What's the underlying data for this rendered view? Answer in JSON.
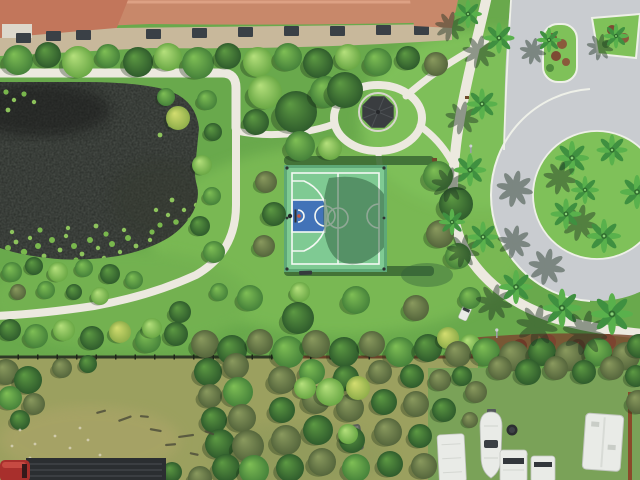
{
  "meta": {
    "kind": "aerial-photograph",
    "subject": "community-basketball-court-and-pond"
  },
  "palette": {
    "grass": "#69a94c",
    "grassLight": "#7fc159",
    "grassDim": "#58923f",
    "water": "#272b27",
    "lily": "#7fc24f",
    "path": "#ece9df",
    "road": "#c9ccd0",
    "curb": "#eef0e8",
    "roofMain": "#c8886a",
    "roofLeft": "#c2765b",
    "facade": "#c8b89b",
    "windowDark": "#3a4046",
    "courtGreen": "#7fca93",
    "courtLine": "#f4f8f3",
    "keyBlue": "#4273b8",
    "gazebo": "#3a3d40",
    "mulch": "#7b4a30",
    "rust": "#8a4a2a",
    "fenceDark": "#2f3a26",
    "fieldTan": "#9ba05f",
    "yardGreen": "#7aa258",
    "vehicleWhite": "#e9ebe7",
    "truckRed": "#a82f2c",
    "trailerDark": "#2b2e31"
  },
  "scene": {
    "regions": [
      "townhomes-with-tile-roofs",
      "pond-with-lily-pads",
      "basketball-court",
      "gazebo",
      "walkway-network",
      "circular-road-with-palm-island",
      "median-islands",
      "perimeter-fence",
      "rough-field",
      "boat-and-rv-yard"
    ],
    "windows": [
      [
        16,
        33
      ],
      [
        46,
        31
      ],
      [
        76,
        30
      ],
      [
        146,
        29
      ],
      [
        192,
        28
      ],
      [
        238,
        27
      ],
      [
        284,
        26
      ],
      [
        330,
        26
      ],
      [
        376,
        25
      ],
      [
        414,
        25
      ]
    ],
    "trees": [
      [
        18,
        60,
        15,
        "md"
      ],
      [
        48,
        55,
        13,
        "dk"
      ],
      [
        78,
        62,
        16,
        "lt"
      ],
      [
        108,
        56,
        12,
        "md"
      ],
      [
        138,
        62,
        15,
        "dk"
      ],
      [
        168,
        57,
        14,
        "lt"
      ],
      [
        198,
        63,
        16,
        "md"
      ],
      [
        228,
        56,
        13,
        "dk"
      ],
      [
        258,
        62,
        15,
        "lt"
      ],
      [
        288,
        57,
        14,
        "md"
      ],
      [
        318,
        63,
        15,
        "dk"
      ],
      [
        348,
        57,
        13,
        "lt"
      ],
      [
        378,
        62,
        14,
        "md"
      ],
      [
        408,
        58,
        12,
        "dk"
      ],
      [
        436,
        64,
        12,
        "ol"
      ],
      [
        265,
        92,
        17,
        "lt"
      ],
      [
        296,
        112,
        21,
        "dk"
      ],
      [
        326,
        92,
        16,
        "md"
      ],
      [
        256,
        122,
        13,
        "dk"
      ],
      [
        300,
        146,
        15,
        "md"
      ],
      [
        330,
        148,
        12,
        "lt"
      ],
      [
        345,
        90,
        18,
        "dk"
      ],
      [
        207,
        100,
        10,
        "md"
      ],
      [
        213,
        132,
        9,
        "dk"
      ],
      [
        202,
        165,
        10,
        "lt"
      ],
      [
        212,
        196,
        9,
        "md"
      ],
      [
        200,
        226,
        10,
        "dk"
      ],
      [
        214,
        252,
        11,
        "md"
      ],
      [
        178,
        118,
        12,
        "yl"
      ],
      [
        166,
        97,
        9,
        "md"
      ],
      [
        266,
        182,
        11,
        "ol"
      ],
      [
        274,
        214,
        12,
        "dk"
      ],
      [
        264,
        246,
        11,
        "ol"
      ],
      [
        438,
        176,
        15,
        "md"
      ],
      [
        456,
        204,
        17,
        "dk"
      ],
      [
        440,
        234,
        14,
        "ol"
      ],
      [
        458,
        256,
        13,
        "md"
      ],
      [
        250,
        298,
        13,
        "md"
      ],
      [
        298,
        318,
        16,
        "dk"
      ],
      [
        356,
        300,
        14,
        "md"
      ],
      [
        300,
        292,
        10,
        "lt"
      ],
      [
        416,
        308,
        13,
        "ol"
      ],
      [
        470,
        298,
        11,
        "md"
      ],
      [
        180,
        312,
        11,
        "dk"
      ],
      [
        219,
        292,
        9,
        "md"
      ],
      [
        12,
        272,
        10,
        "md"
      ],
      [
        34,
        266,
        9,
        "dk"
      ],
      [
        58,
        272,
        10,
        "lt"
      ],
      [
        84,
        268,
        9,
        "md"
      ],
      [
        110,
        274,
        10,
        "dk"
      ],
      [
        134,
        280,
        9,
        "md"
      ],
      [
        18,
        292,
        8,
        "ol"
      ],
      [
        46,
        290,
        9,
        "md"
      ],
      [
        74,
        292,
        8,
        "dk"
      ],
      [
        100,
        296,
        9,
        "lt"
      ],
      [
        10,
        330,
        11,
        "dk"
      ],
      [
        36,
        336,
        12,
        "md"
      ],
      [
        64,
        330,
        11,
        "lt"
      ],
      [
        92,
        338,
        12,
        "dk"
      ],
      [
        120,
        332,
        11,
        "yl"
      ],
      [
        148,
        340,
        13,
        "md"
      ],
      [
        176,
        334,
        12,
        "dk"
      ],
      [
        152,
        328,
        10,
        "lt"
      ],
      [
        205,
        344,
        14,
        "ol"
      ],
      [
        232,
        350,
        15,
        "dk"
      ],
      [
        260,
        342,
        13,
        "ol"
      ],
      [
        288,
        352,
        16,
        "md"
      ],
      [
        316,
        344,
        14,
        "ol"
      ],
      [
        344,
        352,
        15,
        "dk"
      ],
      [
        372,
        344,
        13,
        "ol"
      ],
      [
        400,
        352,
        15,
        "md"
      ],
      [
        428,
        348,
        14,
        "dk"
      ],
      [
        448,
        338,
        11,
        "yl"
      ],
      [
        470,
        344,
        10,
        "lt"
      ],
      [
        458,
        354,
        13,
        "ol"
      ],
      [
        486,
        352,
        14,
        "md"
      ],
      [
        514,
        356,
        15,
        "ol"
      ],
      [
        542,
        352,
        14,
        "dk"
      ],
      [
        570,
        356,
        15,
        "ol"
      ],
      [
        598,
        352,
        14,
        "md"
      ],
      [
        626,
        356,
        14,
        "ol"
      ],
      [
        639,
        346,
        12,
        "dk"
      ],
      [
        6,
        372,
        13,
        "ol"
      ],
      [
        28,
        380,
        14,
        "dk"
      ],
      [
        10,
        398,
        12,
        "md"
      ],
      [
        34,
        404,
        11,
        "ol"
      ],
      [
        20,
        420,
        10,
        "dk"
      ],
      [
        62,
        368,
        10,
        "ol"
      ],
      [
        88,
        364,
        9,
        "dk"
      ],
      [
        208,
        372,
        14,
        "dk"
      ],
      [
        236,
        366,
        13,
        "ol"
      ],
      [
        210,
        396,
        12,
        "ol"
      ],
      [
        238,
        392,
        15,
        "md"
      ],
      [
        214,
        420,
        13,
        "dk"
      ],
      [
        242,
        418,
        14,
        "ol"
      ],
      [
        220,
        444,
        15,
        "dk"
      ],
      [
        248,
        446,
        16,
        "ol"
      ],
      [
        226,
        468,
        14,
        "dk"
      ],
      [
        254,
        470,
        15,
        "md"
      ],
      [
        282,
        380,
        14,
        "ol"
      ],
      [
        282,
        410,
        13,
        "dk"
      ],
      [
        286,
        440,
        15,
        "ol"
      ],
      [
        290,
        468,
        14,
        "dk"
      ],
      [
        312,
        372,
        13,
        "md"
      ],
      [
        316,
        400,
        14,
        "ol"
      ],
      [
        318,
        430,
        15,
        "dk"
      ],
      [
        322,
        462,
        14,
        "ol"
      ],
      [
        346,
        378,
        13,
        "dk"
      ],
      [
        350,
        408,
        14,
        "ol"
      ],
      [
        352,
        440,
        13,
        "dk"
      ],
      [
        356,
        468,
        14,
        "md"
      ],
      [
        380,
        372,
        12,
        "ol"
      ],
      [
        384,
        402,
        13,
        "dk"
      ],
      [
        388,
        432,
        14,
        "ol"
      ],
      [
        390,
        464,
        13,
        "dk"
      ],
      [
        412,
        376,
        12,
        "dk"
      ],
      [
        416,
        404,
        13,
        "ol"
      ],
      [
        420,
        436,
        12,
        "dk"
      ],
      [
        424,
        466,
        13,
        "ol"
      ],
      [
        330,
        392,
        14,
        "lt"
      ],
      [
        358,
        388,
        12,
        "yl"
      ],
      [
        305,
        388,
        11,
        "lt"
      ],
      [
        440,
        380,
        11,
        "ol"
      ],
      [
        444,
        410,
        12,
        "dk"
      ],
      [
        348,
        434,
        10,
        "lt"
      ],
      [
        500,
        368,
        12,
        "ol"
      ],
      [
        528,
        372,
        13,
        "dk"
      ],
      [
        556,
        368,
        12,
        "ol"
      ],
      [
        584,
        372,
        12,
        "dk"
      ],
      [
        612,
        368,
        12,
        "ol"
      ],
      [
        636,
        376,
        11,
        "dk"
      ],
      [
        638,
        402,
        12,
        "ol"
      ],
      [
        476,
        392,
        11,
        "ol"
      ],
      [
        462,
        376,
        10,
        "dk"
      ],
      [
        470,
        420,
        8,
        "ol"
      ],
      [
        200,
        478,
        12,
        "ol"
      ],
      [
        172,
        472,
        10,
        "dk"
      ]
    ],
    "palms": [
      [
        572,
        158,
        1.1,
        2,
        1
      ],
      [
        612,
        150,
        1.0,
        2,
        1
      ],
      [
        637,
        192,
        1.1,
        2,
        1
      ],
      [
        566,
        214,
        1.0,
        2,
        1
      ],
      [
        604,
        236,
        1.1,
        2,
        1
      ],
      [
        585,
        190,
        0.9,
        0,
        1
      ],
      [
        499,
        38,
        1.0,
        1,
        0
      ],
      [
        482,
        104,
        1.0,
        1,
        1
      ],
      [
        470,
        170,
        1.05,
        1,
        1
      ],
      [
        483,
        237,
        1.0,
        1,
        1
      ],
      [
        516,
        287,
        1.1,
        1,
        1
      ],
      [
        562,
        308,
        1.25,
        1,
        0
      ],
      [
        612,
        314,
        1.35,
        1,
        0
      ],
      [
        549,
        40,
        0.8,
        1,
        0
      ],
      [
        616,
        36,
        0.8,
        1,
        0
      ],
      [
        468,
        14,
        0.9,
        1,
        0
      ],
      [
        452,
        222,
        0.85,
        0,
        0
      ]
    ],
    "lilies": [
      [
        8,
        248,
        3
      ],
      [
        16,
        242,
        2.4
      ],
      [
        24,
        252,
        3.2
      ],
      [
        30,
        238,
        2.2
      ],
      [
        38,
        246,
        3
      ],
      [
        44,
        256,
        2.4
      ],
      [
        52,
        240,
        3
      ],
      [
        60,
        250,
        2.4
      ],
      [
        66,
        236,
        2.2
      ],
      [
        74,
        246,
        3
      ],
      [
        82,
        254,
        2.4
      ],
      [
        90,
        240,
        3
      ],
      [
        98,
        248,
        2.2
      ],
      [
        106,
        234,
        2.6
      ],
      [
        112,
        244,
        3
      ],
      [
        120,
        252,
        2.2
      ],
      [
        128,
        238,
        3
      ],
      [
        136,
        246,
        2.4
      ],
      [
        144,
        254,
        3
      ],
      [
        150,
        240,
        2.2
      ],
      [
        158,
        248,
        2.6
      ],
      [
        20,
        260,
        2.4
      ],
      [
        48,
        262,
        2.2
      ],
      [
        76,
        260,
        2.6
      ],
      [
        104,
        258,
        2.2
      ],
      [
        132,
        258,
        2.6
      ],
      [
        12,
        232,
        2.2
      ],
      [
        40,
        230,
        2.6
      ],
      [
        68,
        228,
        2.2
      ],
      [
        96,
        226,
        2.4
      ],
      [
        124,
        230,
        2.2
      ],
      [
        152,
        232,
        2.6
      ],
      [
        160,
        225,
        2.6
      ],
      [
        168,
        215,
        2.2
      ],
      [
        176,
        222,
        2.8
      ],
      [
        184,
        210,
        2.2
      ],
      [
        190,
        220,
        2.6
      ],
      [
        196,
        205,
        2.2
      ],
      [
        172,
        200,
        2.4
      ],
      [
        156,
        210,
        2.2
      ],
      [
        165,
        100,
        2.4
      ],
      [
        175,
        110,
        2.2
      ],
      [
        185,
        120,
        2.6
      ],
      [
        170,
        125,
        2.2
      ],
      [
        160,
        135,
        2.4
      ],
      [
        6,
        92,
        2.6
      ],
      [
        14,
        100,
        2.2
      ],
      [
        24,
        94,
        2.6
      ],
      [
        34,
        102,
        2.2
      ],
      [
        8,
        110,
        2.4
      ]
    ],
    "logs": [
      [
        118,
        420,
        14,
        -20
      ],
      [
        150,
        428,
        12,
        10
      ],
      [
        178,
        436,
        16,
        -8
      ],
      [
        205,
        430,
        10,
        20
      ],
      [
        96,
        412,
        10,
        -15
      ],
      [
        140,
        415,
        9,
        5
      ],
      [
        165,
        444,
        11,
        -5
      ],
      [
        190,
        452,
        9,
        12
      ]
    ],
    "specks": [
      [
        20,
        430
      ],
      [
        35,
        444
      ],
      [
        55,
        436
      ],
      [
        70,
        448
      ],
      [
        88,
        440
      ],
      [
        30,
        458
      ],
      [
        60,
        462
      ],
      [
        12,
        446
      ],
      [
        100,
        455
      ],
      [
        45,
        470
      ],
      [
        80,
        428
      ],
      [
        110,
        466
      ]
    ]
  }
}
